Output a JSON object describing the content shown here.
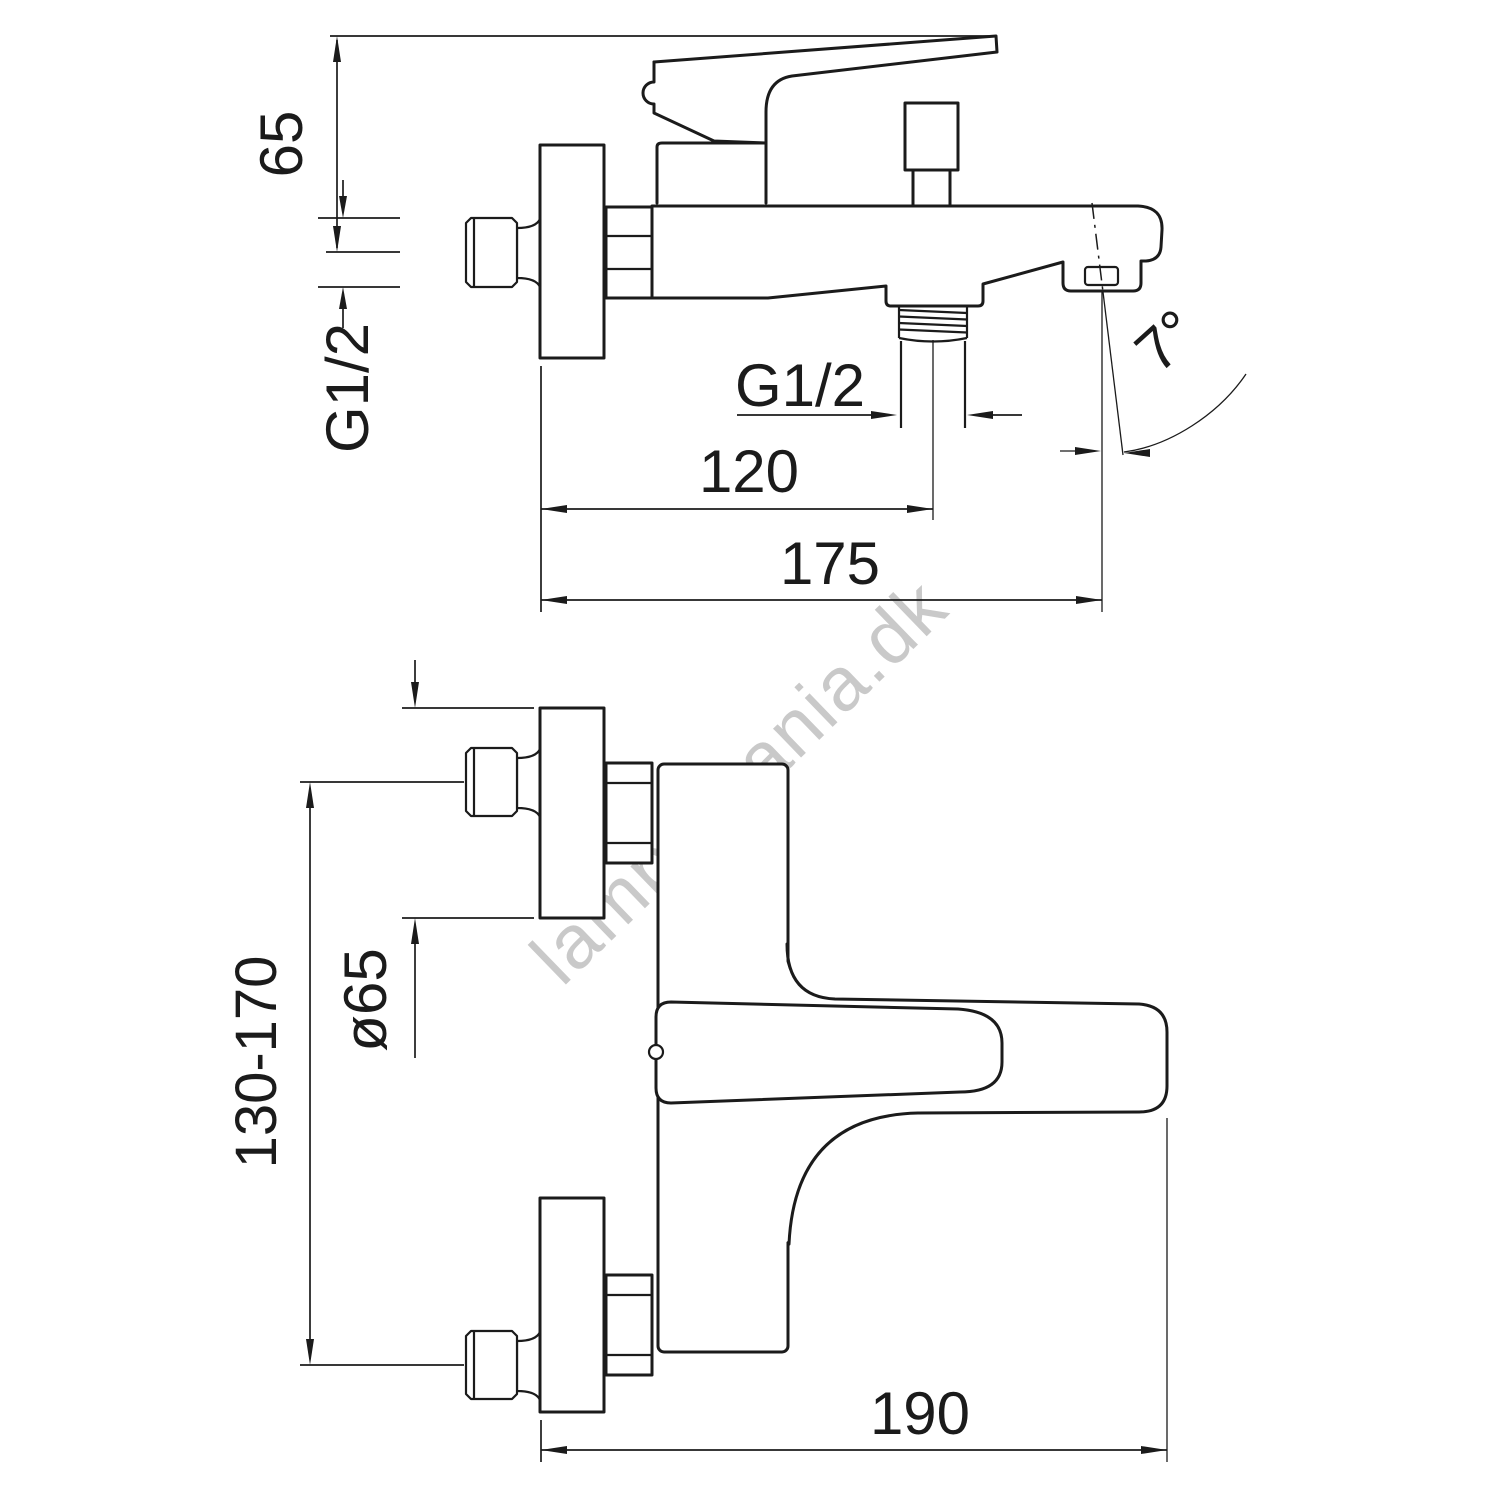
{
  "side_view": {
    "handle_height": "65",
    "wall_thread": "G1/2",
    "shower_outlet_thread": "G1/2",
    "outlet_center_distance": "120",
    "spout_reach": "175",
    "spout_angle": "7°"
  },
  "front_view": {
    "flange_diameter": "ø65",
    "connection_span": "130-170",
    "overall_width": "190"
  },
  "watermark": {
    "text": "lampemania.dk"
  },
  "colors": {
    "line": "#1b1b1b",
    "watermark": "#c9c9c9",
    "background": "#ffffff"
  }
}
